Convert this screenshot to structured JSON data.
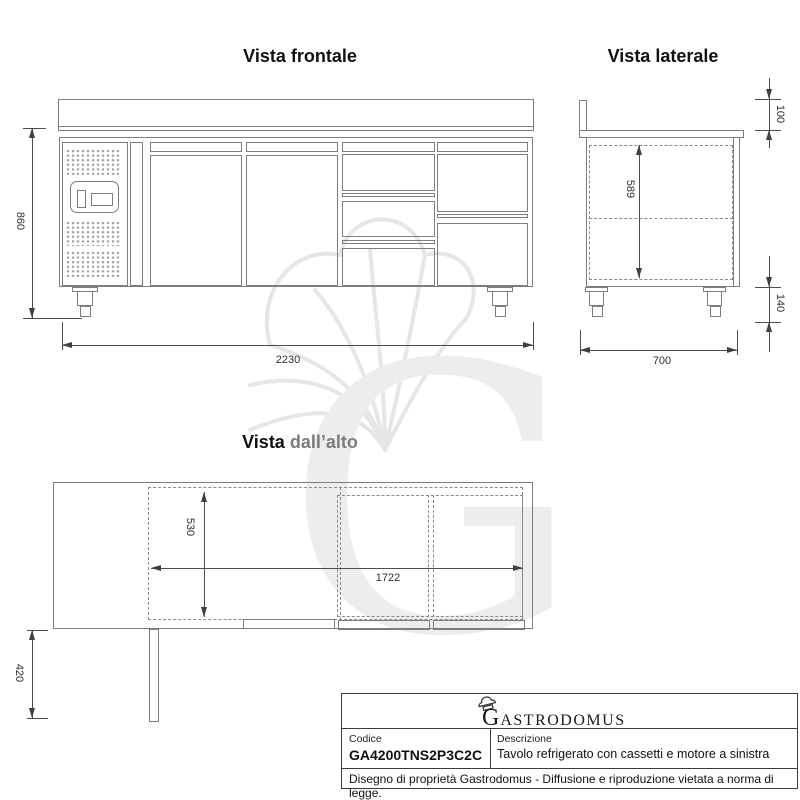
{
  "colors": {
    "line": "#7d7d7d",
    "dim_line": "#4d4d4d",
    "dash_line": "#8a8a8a",
    "text": "#1f1f1f",
    "title_gray": "#7c7c7c",
    "watermark": "#ededed",
    "table_border": "#3c3c3c"
  },
  "views": {
    "front": {
      "title": "Vista frontale",
      "dim_height": "860",
      "dim_width": "2230"
    },
    "side": {
      "title": "Vista laterale",
      "dim_top": "100",
      "dim_inner_height": "589",
      "dim_feet": "140",
      "dim_depth": "700"
    },
    "top": {
      "title_prefix": "Vista",
      "title_suffix": "dall’alto",
      "dim_inner_depth": "530",
      "dim_inner_width": "1722",
      "dim_motor_depth": "420"
    }
  },
  "watermark": {
    "letter": "G"
  },
  "title_block": {
    "brand_initial": "G",
    "brand_rest": "ASTRODOMUS",
    "codice_label": "Codice",
    "codice_value": "GA4200TNS2P3C2C",
    "descrizione_label": "Descrizione",
    "descrizione_value": "Tavolo refrigerato con cassetti e motore a sinistra",
    "note": "Disegno di proprietà Gastrodomus - Diffusione e riproduzione vietata a norma di legge."
  }
}
